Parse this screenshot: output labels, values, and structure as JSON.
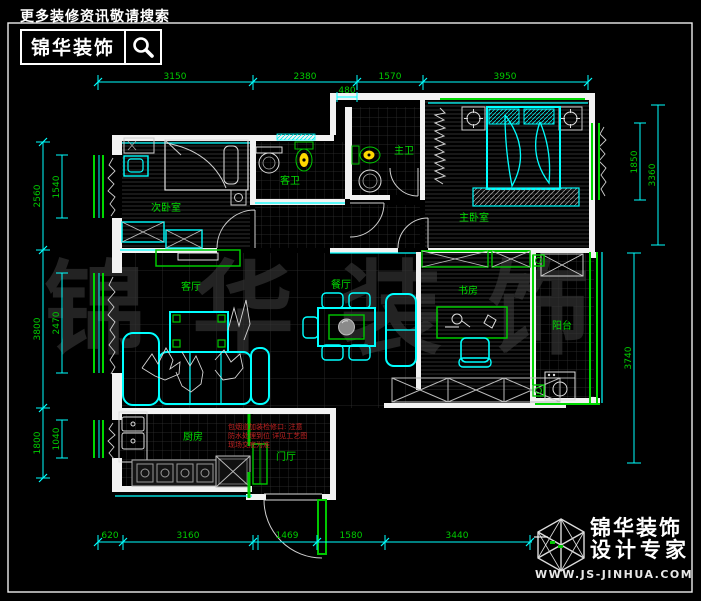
{
  "header": {
    "tagline": "更多装修资讯敬请搜索",
    "brand": "锦华装饰"
  },
  "watermark": {
    "text": "锦华装饰"
  },
  "footer": {
    "brand": "锦华装饰",
    "subtitle": "设计专家",
    "website": "WWW.JS-JINHUA.COM"
  },
  "rooms": [
    {
      "id": "secondary-bedroom",
      "label": "次卧室"
    },
    {
      "id": "guest-bath",
      "label": "客卫"
    },
    {
      "id": "master-bath",
      "label": "主卫"
    },
    {
      "id": "master-bedroom",
      "label": "主卧室"
    },
    {
      "id": "living-room",
      "label": "客厅"
    },
    {
      "id": "dining-room",
      "label": "餐厅"
    },
    {
      "id": "study",
      "label": "书房"
    },
    {
      "id": "balcony",
      "label": "阳台"
    },
    {
      "id": "kitchen",
      "label": "厨房"
    },
    {
      "id": "entry-hall",
      "label": "门厅"
    }
  ],
  "annotation": {
    "lines": [
      "包烟道加装检修口: 注意",
      "防水处理到位 详见工艺图",
      "现场交底为准"
    ]
  },
  "dims": {
    "top": [
      "3150",
      "2380",
      "1570",
      "3950"
    ],
    "top_sub": "480",
    "bottom": [
      "620",
      "3160",
      "1469",
      "1580",
      "3440"
    ],
    "left_outer": [
      "2560",
      "3800",
      "1800"
    ],
    "left_inner": [
      "1540",
      "2470",
      "1040"
    ],
    "right_top": "3360",
    "right_window": "1850",
    "right_bottom": "3740"
  },
  "colors": {
    "dim_line": "#00ffff",
    "dim_text": "#00cc00",
    "room_label": "#00dd00",
    "wall": "#f2f2f2",
    "window": "#00d800",
    "soft_furniture": "#00ffff",
    "annotation": "#cc2222",
    "toilet": "#ffd800"
  }
}
